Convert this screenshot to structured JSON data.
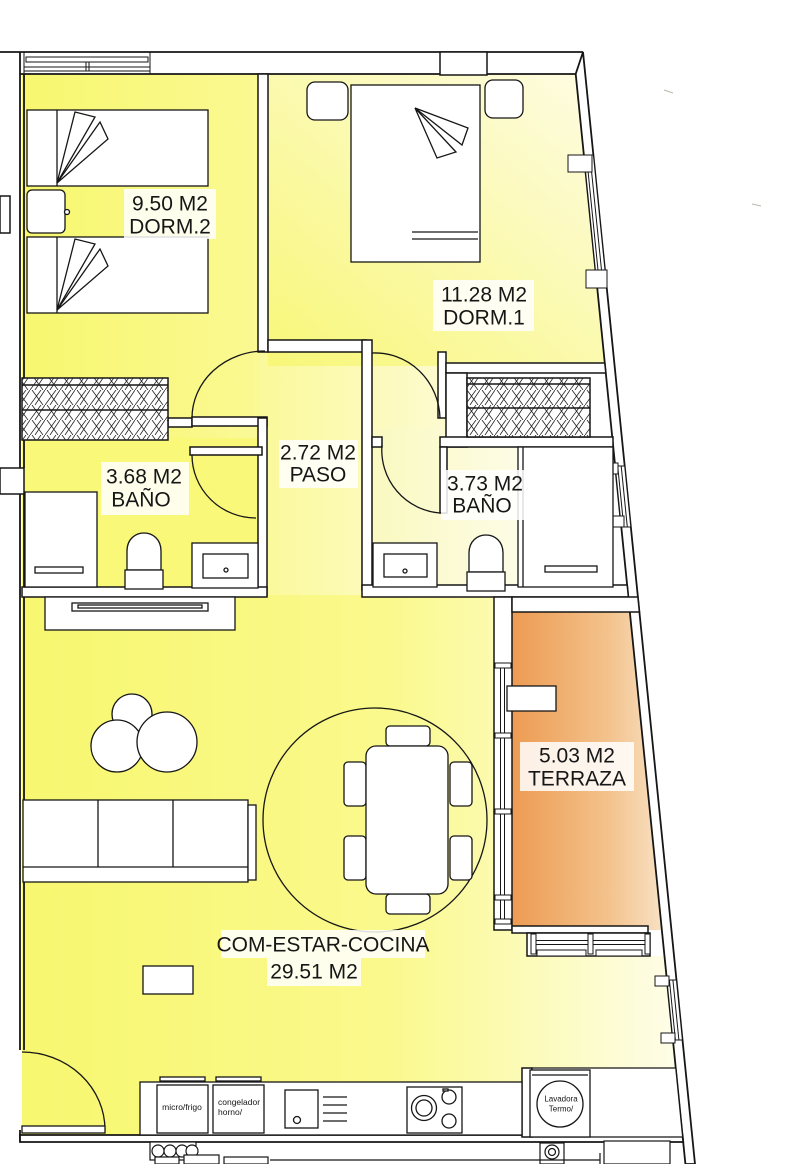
{
  "rooms": {
    "dorm2": {
      "area": "9.50 M2",
      "name": "DORM.2"
    },
    "dorm1": {
      "area": "11.28 M2",
      "name": "DORM.1"
    },
    "paso": {
      "area": "2.72 M2",
      "name": "PASO"
    },
    "bano1": {
      "area": "3.68 M2",
      "name": "BAÑO"
    },
    "bano2": {
      "area": "3.73 M2",
      "name": "BAÑO"
    },
    "terraza": {
      "area": "5.03 M2",
      "name": "TERRAZA"
    },
    "salon": {
      "name": "COM-ESTAR-COCINA",
      "area": "29.51 M2"
    }
  },
  "appliances": {
    "micro_frigo": "micro/frigo",
    "congelador": "congelador",
    "horno": "horno/",
    "lavadora": "Lavadora",
    "termo": "Termo/"
  },
  "colors": {
    "room_yellow": "#F9F878",
    "room_yellow_light": "#FBFA96",
    "room_cream": "#FEFCE6",
    "terraza_orange": "#ED9C55",
    "terraza_pale": "#F8E2C4",
    "wall": "#161616"
  }
}
